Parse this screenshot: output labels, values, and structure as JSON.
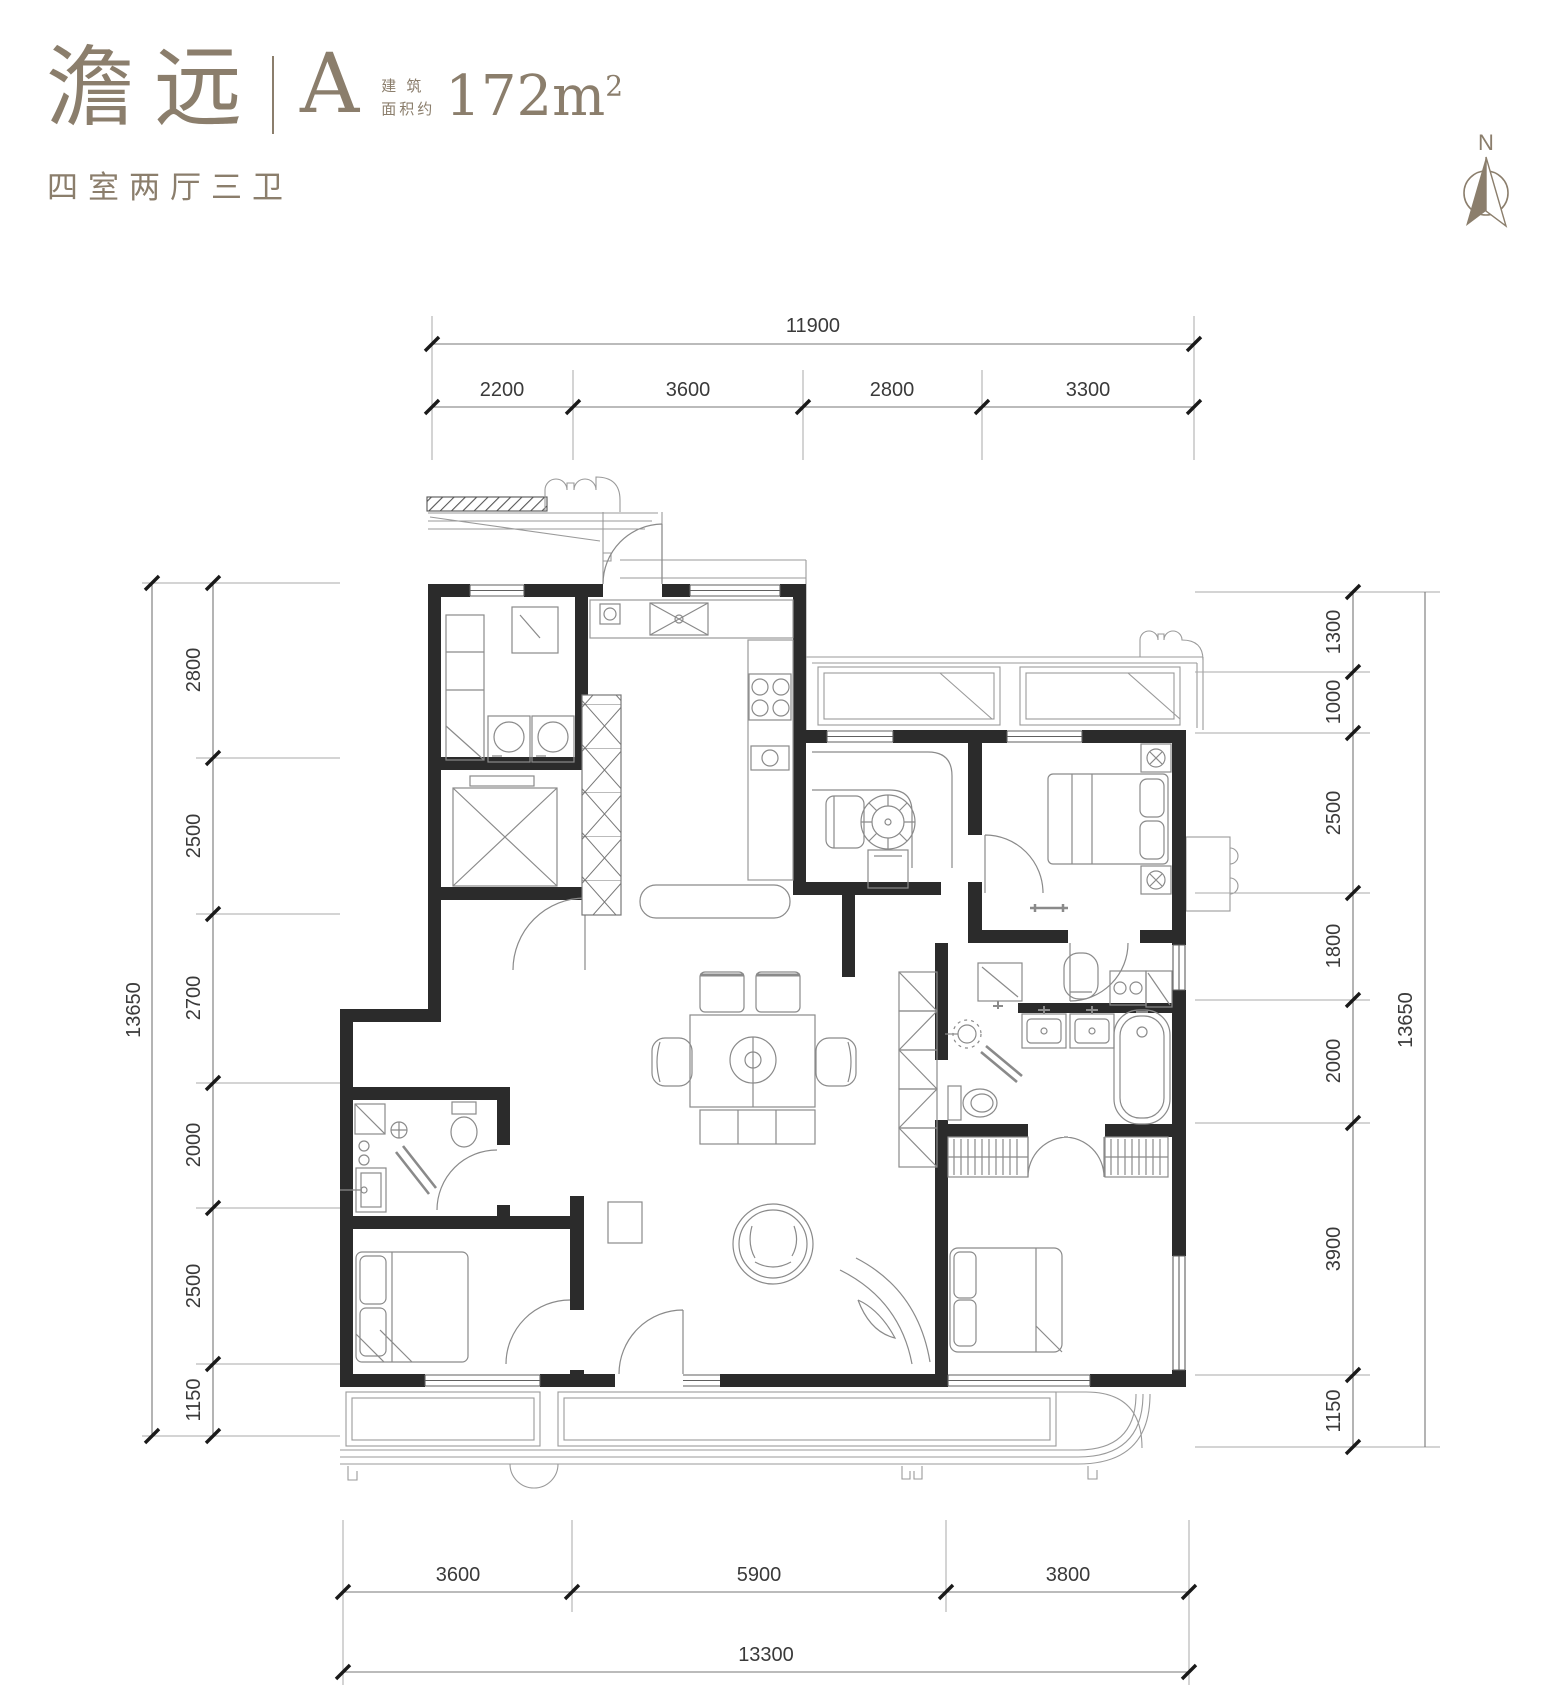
{
  "header": {
    "project_name": "澹远",
    "unit_label": "A",
    "area_caption_line1": "建 筑",
    "area_caption_line2": "面积约",
    "area_value": "172m",
    "area_exponent": "2",
    "layout_description": "四室两厅三卫"
  },
  "compass": {
    "north_label": "N"
  },
  "colors": {
    "accent": "#8B7E6C",
    "wall": "#2B2B2B",
    "dimension_text": "#3A3A3A"
  },
  "dimensions": {
    "top": {
      "total": "11900",
      "segments": [
        "2200",
        "3600",
        "2800",
        "3300"
      ]
    },
    "left": {
      "total": "13650",
      "segments": [
        "2800",
        "2500",
        "2700",
        "2000",
        "2500",
        "1150"
      ]
    },
    "right": {
      "total": "13650",
      "segments": [
        "1300",
        "1000",
        "2500",
        "1800",
        "2000",
        "3900",
        "1150"
      ]
    },
    "bottom": {
      "total": "13300",
      "segments": [
        "3600",
        "5900",
        "3800"
      ]
    }
  }
}
